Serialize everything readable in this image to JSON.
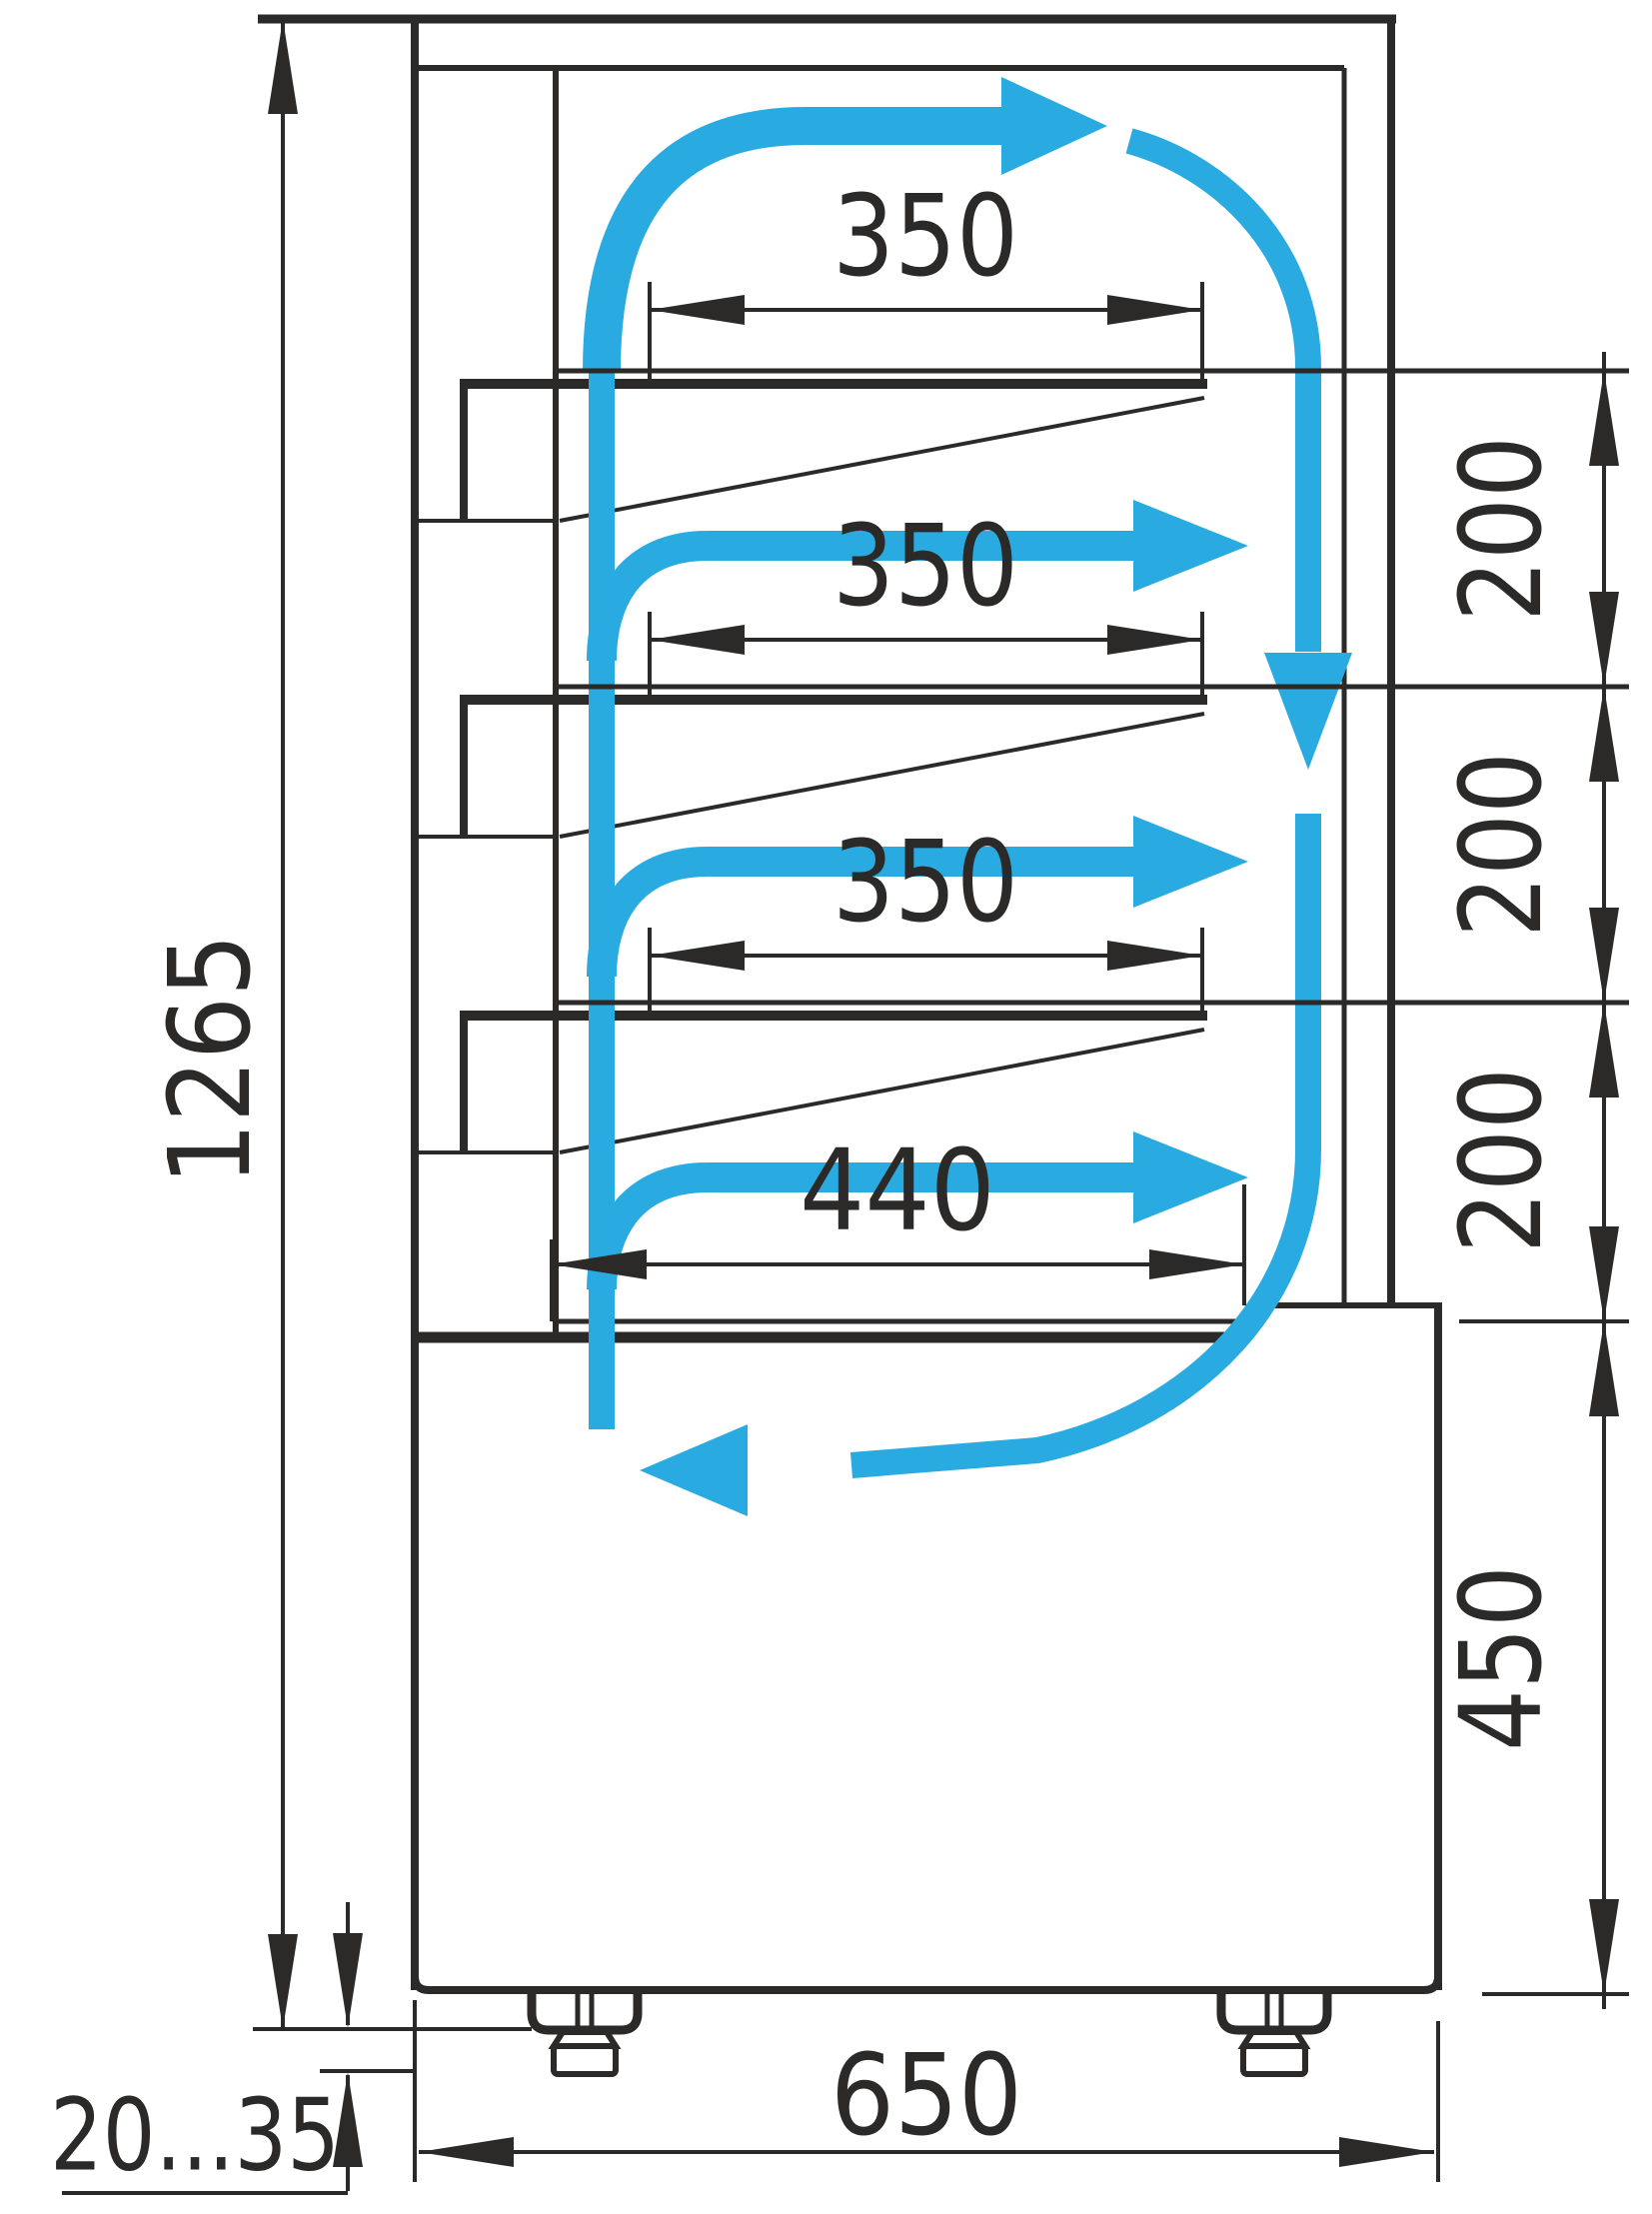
{
  "drawing": {
    "type": "technical-dimension-drawing",
    "subject": "Refrigerated patisserie display case - side cross-section with air circulation",
    "colors": {
      "line": "#2b2a29",
      "airflow": "#29abe2",
      "background": "#ffffff"
    },
    "dimensions": {
      "overall_height": "1265",
      "shelf_1_depth": "350",
      "shelf_2_depth": "350",
      "shelf_3_depth": "350",
      "bottom_shelf_depth": "440",
      "tier_gap_1": "200",
      "tier_gap_2": "200",
      "tier_gap_3": "200",
      "base_height": "450",
      "overall_depth": "650",
      "leg_adjust_range": "20...35"
    }
  }
}
